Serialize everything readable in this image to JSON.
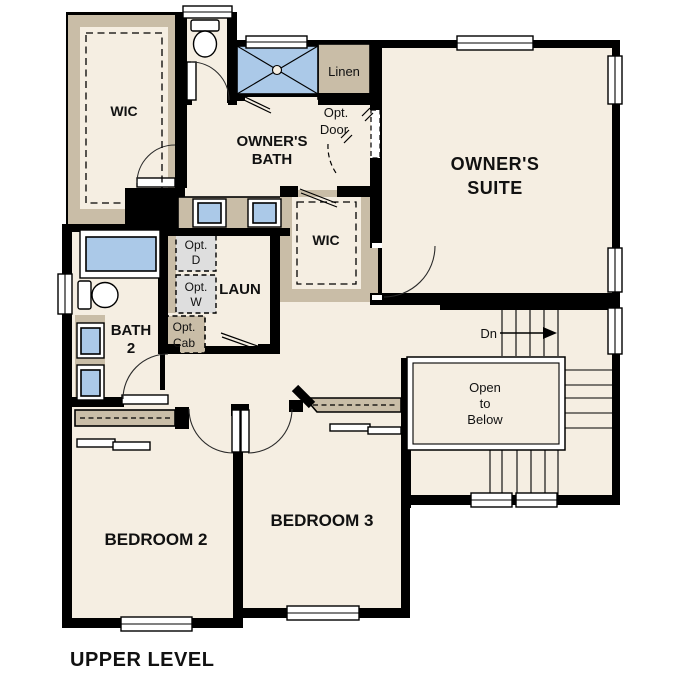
{
  "plan_title": "UPPER LEVEL",
  "colors": {
    "room_fill": "#f5eee2",
    "wall_tan": "#c9bda7",
    "fixture_blue": "#abc9e8",
    "optional_grey": "#dedede",
    "wall_black": "#000000"
  },
  "labels": {
    "wic_master": "WIC",
    "owners_bath": [
      "OWNER'S",
      "BATH"
    ],
    "linen": "Linen",
    "opt_door": [
      "Opt.",
      "Door"
    ],
    "owners_suite": [
      "OWNER'S",
      "SUITE"
    ],
    "wic_2": "WIC",
    "opt_dryer": [
      "Opt.",
      "D"
    ],
    "opt_washer": [
      "Opt.",
      "W"
    ],
    "laundry": "LAUN",
    "opt_cab": [
      "Opt.",
      "Cab"
    ],
    "bath_2": [
      "BATH",
      "2"
    ],
    "stairs_down": "Dn",
    "open_to_below": [
      "Open",
      "to",
      "Below"
    ],
    "bedroom_2": "BEDROOM 2",
    "bedroom_3": "BEDROOM 3"
  }
}
